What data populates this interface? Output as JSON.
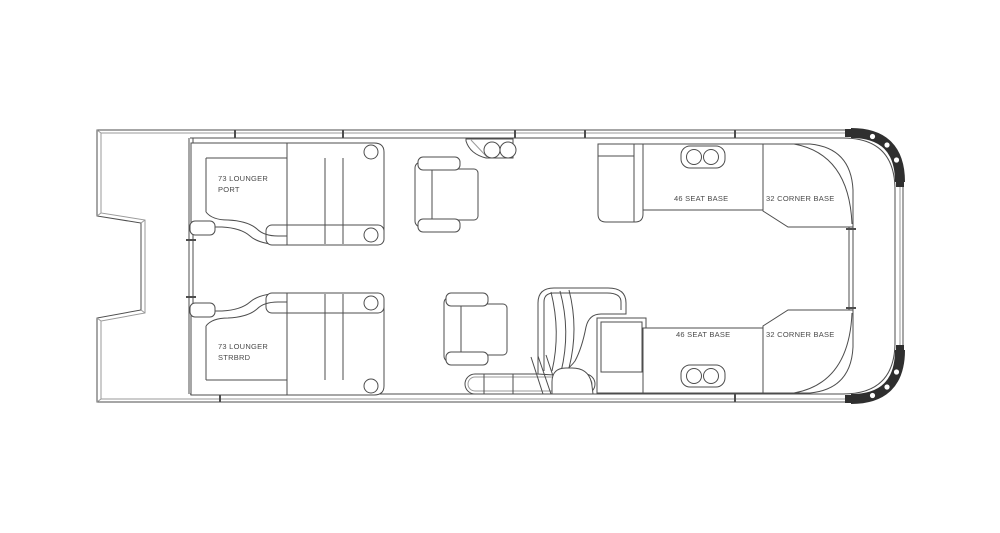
{
  "window": {
    "background": "#ffffff"
  },
  "colors": {
    "line": "#4d4d4d",
    "line_light": "#9a9a9a",
    "fill": "#ffffff",
    "corner_cap": "#2f2f2f",
    "label_text": "#4a4a4a"
  },
  "diagram": {
    "type": "boat-floor-plan",
    "labels": {
      "lounger_port": {
        "line1": "73 LOUNGER",
        "line2": "PORT"
      },
      "lounger_starboard": {
        "line1": "73 LOUNGER",
        "line2": "STRBRD"
      },
      "seat_base_port": {
        "text": "46 SEAT BASE"
      },
      "corner_base_port": {
        "text": "32 CORNER BASE"
      },
      "seat_base_starboard": {
        "text": "46 SEAT BASE"
      },
      "corner_base_starboard": {
        "text": "32 CORNER BASE"
      }
    }
  }
}
